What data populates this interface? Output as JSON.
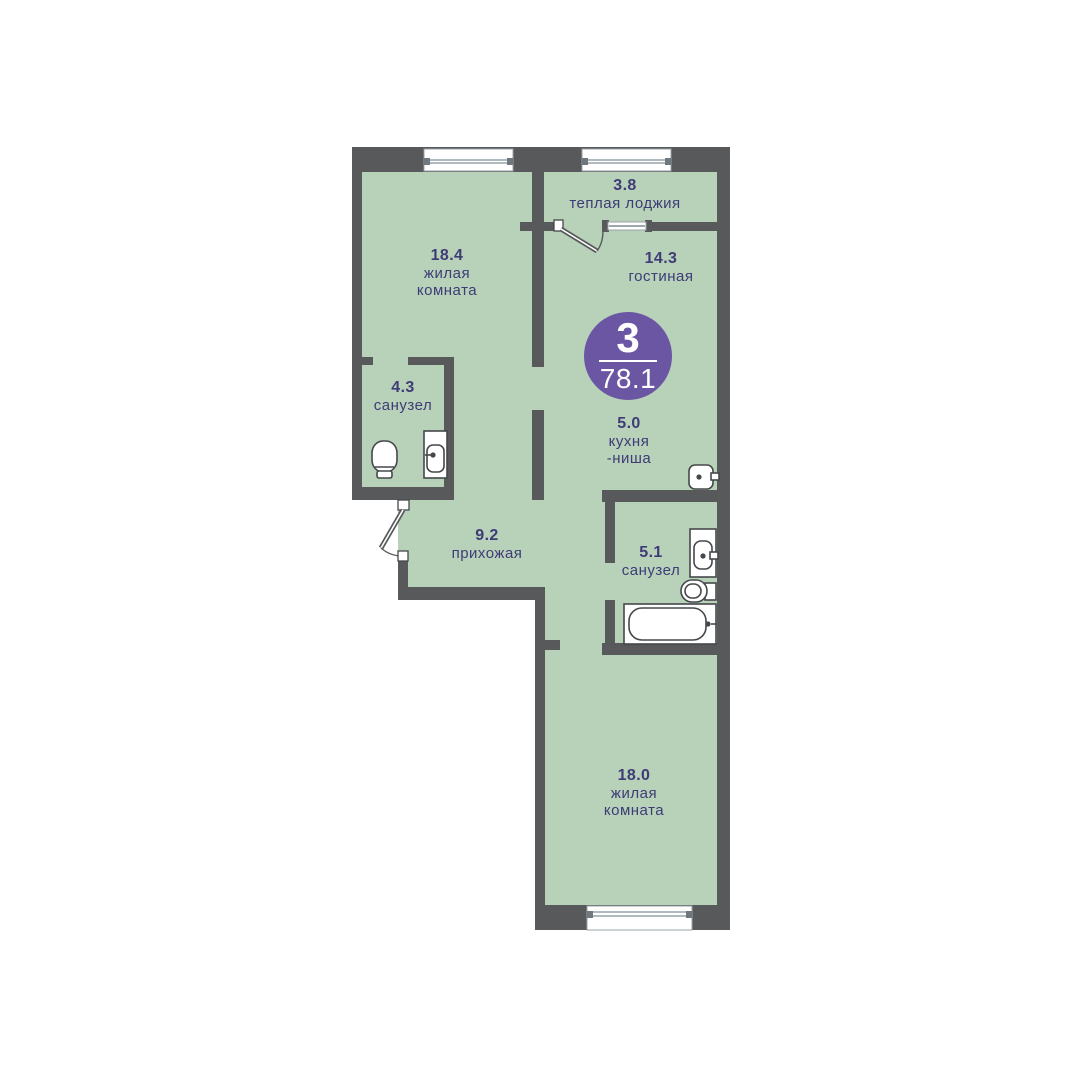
{
  "plan": {
    "badge": {
      "rooms_count": "3",
      "total_area": "78.1"
    },
    "rooms": [
      {
        "id": "living-1",
        "area": "18.4",
        "name": [
          "жилая",
          "комната"
        ]
      },
      {
        "id": "loggia",
        "area": "3.8",
        "name": [
          "теплая лоджия"
        ]
      },
      {
        "id": "lounge",
        "area": "14.3",
        "name": [
          "гостиная"
        ]
      },
      {
        "id": "kitchen-niche",
        "area": "5.0",
        "name": [
          "кухня",
          "-ниша"
        ]
      },
      {
        "id": "bathroom-1",
        "area": "4.3",
        "name": [
          "санузел"
        ]
      },
      {
        "id": "hallway",
        "area": "9.2",
        "name": [
          "прихожая"
        ]
      },
      {
        "id": "bathroom-2",
        "area": "5.1",
        "name": [
          "санузел"
        ]
      },
      {
        "id": "living-2",
        "area": "18.0",
        "name": [
          "жилая",
          "комната"
        ]
      }
    ]
  },
  "colors": {
    "wall": "#57595B",
    "room_fill": "#B8D2B9",
    "accent": "#6B56A3",
    "ink": "#3E3B76",
    "fixture_stroke": "#45484B",
    "glass": "#7C8B94"
  }
}
